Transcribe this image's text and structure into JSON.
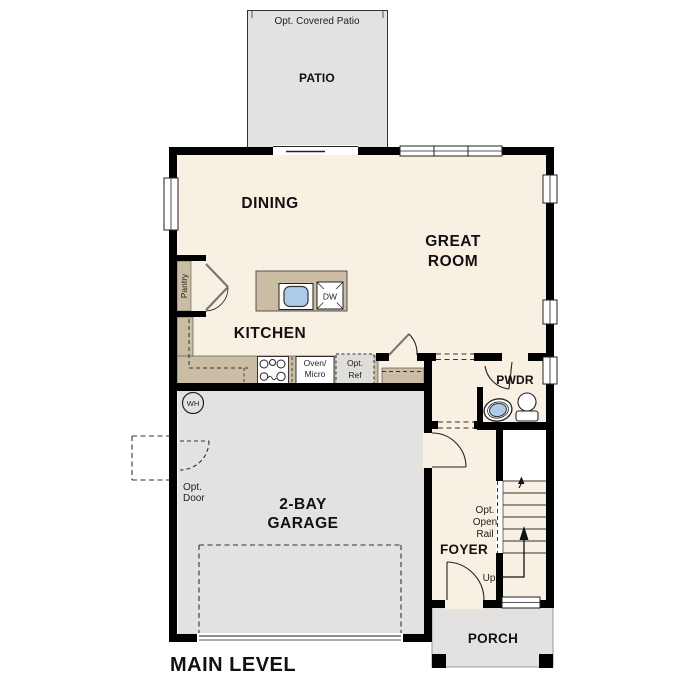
{
  "level": {
    "label": "MAIN LEVEL"
  },
  "rooms": {
    "patio": {
      "name": "PATIO",
      "note": "Opt. Covered Patio"
    },
    "dining": {
      "name": "DINING"
    },
    "great_room": {
      "line1": "GREAT",
      "line2": "ROOM"
    },
    "kitchen": {
      "name": "KITCHEN"
    },
    "pantry": {
      "name": "Pantry"
    },
    "powder": {
      "name": "PWDR"
    },
    "garage": {
      "line1": "2-BAY",
      "line2": "GARAGE"
    },
    "foyer": {
      "name": "FOYER"
    },
    "porch": {
      "name": "PORCH"
    }
  },
  "fixtures": {
    "water_heater": "WH",
    "dishwasher": "DW",
    "oven_micro": {
      "line1": "Oven/",
      "line2": "Micro"
    },
    "opt_ref": {
      "line1": "Opt.",
      "line2": "Ref"
    }
  },
  "annotations": {
    "opt_door": {
      "line1": "Opt.",
      "line2": "Door"
    },
    "opt_open_rail": {
      "line1": "Opt.",
      "line2": "Open",
      "line3": "Rail"
    },
    "stairs_up": "Up"
  },
  "colors": {
    "wall": "#000000",
    "interior_floor": "#f8f0e2",
    "concrete": "#e3e2e0",
    "counter": "#cbbda4",
    "sink_blue": "#aecbea",
    "optional_appliance": "#e0ded8",
    "background": "#ffffff"
  }
}
